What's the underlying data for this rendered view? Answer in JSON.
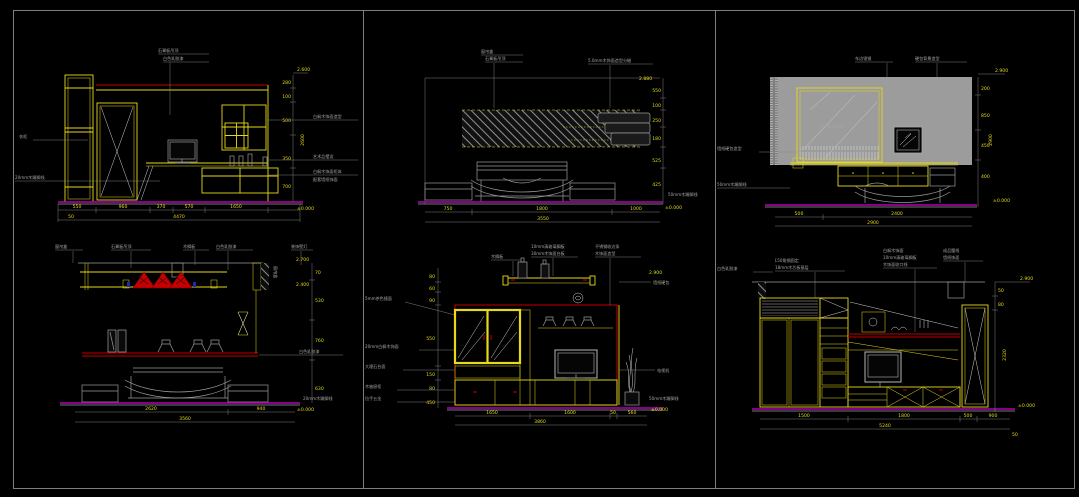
{
  "sheet": {
    "background": "#000000",
    "border_color": "#7d7d86",
    "accent_yellow": "#e6d919",
    "accent_red": "#c40000",
    "accent_magenta": "#b400b4",
    "wall_gray": "#9c9c9c"
  },
  "panels": {
    "p1": {
      "top_label_1": "石膏板吊顶",
      "top_label_2": "白色乳胶漆",
      "left_label_1": "衣柜",
      "left_label_2": "20mm木踢脚线",
      "right_label_1": "白枫木饰面造型",
      "right_label_2": "艺术品摆设",
      "right_label_3": "白枫木饰面柜体",
      "right_label_4": "配套墙纸饰面",
      "dims_bottom": [
        "550",
        "960",
        "370",
        "570",
        "1650"
      ],
      "dim_sub": "50",
      "dim_total": "4470",
      "dims_right": [
        "280",
        "100",
        "500",
        "350",
        "700"
      ],
      "dim_right_total": "2600",
      "level_top": "2.600",
      "level_bottom": "±0.000"
    },
    "p2": {
      "top_label_1": "窗帘盒",
      "top_label_2": "石膏板吊顶",
      "top_label_3": "5.0mm木饰面造型分缝",
      "right_label_1": "50mm木踢脚线",
      "dims_bottom": [
        "750",
        "1800",
        "1000"
      ],
      "dim_total": "3550",
      "dims_right": [
        "550",
        "100",
        "250",
        "180",
        "525",
        "425"
      ],
      "level_top": "2.880",
      "level_bottom": "±0.000"
    },
    "p3": {
      "top_label_1": "车边银镜",
      "top_label_2": "硬包背景造型",
      "mirror_label": "艺术墙纸饰面",
      "left_label_1": "墙纸硬包造型",
      "left_label_2": "50mm木踢脚线",
      "dims_bottom": [
        "500",
        "2400"
      ],
      "dim_total": "2900",
      "dims_right": [
        "200",
        "850",
        "450",
        "400"
      ],
      "dim_right_total": "2900",
      "level_top": "2.900",
      "level_bottom": "±0.000"
    },
    "p4": {
      "top_labels": [
        "窗帘盒",
        "石膏板吊顶",
        "木搁板",
        "白色乳胶漆",
        "装饰壁灯"
      ],
      "vert_label": "窗帘盒",
      "mid_right_label": "白色乳胶漆",
      "bottom_right_label": "20mm木踢脚线",
      "dims_bottom": [
        "2620",
        "940"
      ],
      "dim_total": "3560",
      "dims_right": [
        "70",
        "530",
        "760",
        "630"
      ],
      "level_top_1": "2.700",
      "level_top_2": "2.400",
      "level_bottom": "±0.000"
    },
    "p5": {
      "left_labels": [
        "5mm茶色镜面",
        "20mm白枫木饰面",
        "大理石台面",
        "木抽屉柜",
        "拉手五金"
      ],
      "top_label_1": "木搁板",
      "top_label_2a": "10mm清玻璃搁板",
      "top_label_2b": "30mm木饰面台板",
      "top_label_3a": "不锈钢收边条",
      "top_label_3b": "木饰面造型",
      "right_label_1": "墙纸硬包",
      "right_label_2": "电视机",
      "right_label_3": "50mm木踢脚线",
      "dims_left": [
        "80",
        "60",
        "90",
        "550",
        "150",
        "80",
        "450"
      ],
      "dims_bottom": [
        "1650",
        "1600",
        "50",
        "560"
      ],
      "dim_total": "3860",
      "level_top": "2.900",
      "level_bottom": "±0.000"
    },
    "p6": {
      "left_label_1": "白色乳胶漆",
      "left_label_2a": "L50角钢固定",
      "left_label_2b": "18mm木芯板基层",
      "mid_label_a": "白枫木饰面",
      "mid_label_b": "10mm清玻璃搁板",
      "mid_label_c": "木饰面收口线",
      "right_top_label_a": "成品腰线",
      "right_top_label_b": "墙纸饰面",
      "dims_right": [
        "50",
        "80"
      ],
      "dim_right_total": "2320",
      "dims_bottom": [
        "1500",
        "1800",
        "500",
        "900"
      ],
      "dim_total": "5240",
      "dim_sub": "50",
      "level_top": "2.900",
      "level_bottom": "±0.000"
    }
  }
}
